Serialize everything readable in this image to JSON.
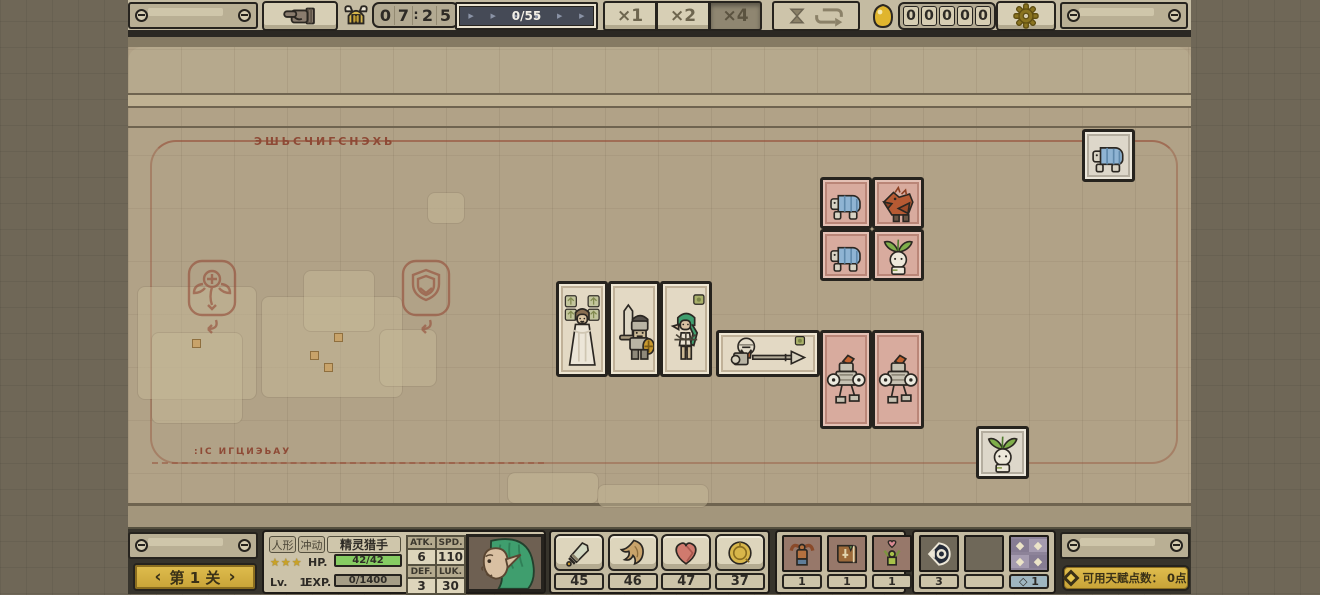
{
  "topbar": {
    "timer_digits": [
      "0",
      "7",
      "2",
      "5"
    ],
    "timer_colon": ":",
    "progress_text": "0/55",
    "speeds": [
      {
        "id": "x1",
        "label": "×1",
        "active": false
      },
      {
        "id": "x2",
        "label": "×2",
        "active": false
      },
      {
        "id": "x4",
        "label": "×4",
        "active": true
      }
    ],
    "gold_digits": [
      "0",
      "0",
      "0",
      "0",
      "0"
    ]
  },
  "board": {
    "rune_top": "ЭШЬСЧИГСНЭХЬ",
    "rune_bottom": ":IС ИГЦИЭЬАУ",
    "blobs": [
      {
        "x": 10,
        "y": 254,
        "w": 118,
        "h": 112
      },
      {
        "x": 24,
        "y": 300,
        "w": 90,
        "h": 90
      },
      {
        "x": 134,
        "y": 264,
        "w": 140,
        "h": 100
      },
      {
        "x": 176,
        "y": 238,
        "w": 70,
        "h": 60
      },
      {
        "x": 252,
        "y": 297,
        "w": 56,
        "h": 56
      },
      {
        "x": 300,
        "y": 160,
        "w": 36,
        "h": 30
      },
      {
        "x": 380,
        "y": 440,
        "w": 90,
        "h": 30
      },
      {
        "x": 470,
        "y": 452,
        "w": 110,
        "h": 22
      }
    ],
    "dots": [
      {
        "x": 64,
        "y": 306
      },
      {
        "x": 182,
        "y": 318
      },
      {
        "x": 206,
        "y": 300
      },
      {
        "x": 196,
        "y": 330
      }
    ],
    "links": [
      {
        "dir": "v",
        "x": 706,
        "y": 163,
        "w": 6,
        "h": 66
      },
      {
        "dir": "h",
        "x": 700,
        "y": 316,
        "w": 88,
        "h": 5
      },
      {
        "dir": "h",
        "x": 700,
        "y": 354,
        "w": 88,
        "h": 5
      }
    ],
    "units": [
      {
        "type": "turtle",
        "style": "gray",
        "x": 954,
        "y": 96,
        "w": 53,
        "h": 53
      },
      {
        "type": "turtle",
        "style": "pink",
        "x": 692,
        "y": 144,
        "w": 52,
        "h": 52
      },
      {
        "type": "dragon",
        "style": "pink",
        "x": 744,
        "y": 144,
        "w": 52,
        "h": 52
      },
      {
        "type": "turtle",
        "style": "pink",
        "x": 692,
        "y": 196,
        "w": 52,
        "h": 52
      },
      {
        "type": "sprout",
        "style": "pink",
        "x": 744,
        "y": 196,
        "w": 52,
        "h": 52
      },
      {
        "type": "lady",
        "style": "cream",
        "x": 428,
        "y": 248,
        "w": 52,
        "h": 96
      },
      {
        "type": "knight",
        "style": "cream",
        "x": 480,
        "y": 248,
        "w": 52,
        "h": 96
      },
      {
        "type": "elf",
        "style": "cream",
        "x": 532,
        "y": 248,
        "w": 52,
        "h": 96
      },
      {
        "type": "lancer",
        "style": "cream",
        "x": 588,
        "y": 297,
        "w": 104,
        "h": 47
      },
      {
        "type": "robot",
        "style": "pink",
        "x": 692,
        "y": 297,
        "w": 52,
        "h": 99
      },
      {
        "type": "robot",
        "style": "pink",
        "x": 744,
        "y": 297,
        "w": 52,
        "h": 99
      },
      {
        "type": "sprout",
        "style": "gray",
        "x": 848,
        "y": 393,
        "w": 53,
        "h": 53
      }
    ]
  },
  "bottombar": {
    "stage_label": "第 1 关",
    "chevron_left": "‹",
    "chevron_right": "›",
    "character": {
      "race_tag": "人形",
      "trait_tag": "冲动",
      "name": "精灵猎手",
      "stars": "★★★",
      "lv_label": "Lv.",
      "lv_value": "1",
      "hp_label": "HP.",
      "hp_value": "42/42",
      "exp_label": "EXP.",
      "exp_value": "0/1400",
      "stats": [
        {
          "label": "ATK.",
          "value": "6"
        },
        {
          "label": "SPD.",
          "value": "110"
        },
        {
          "label": "DEF.",
          "value": "3"
        },
        {
          "label": "LUK.",
          "value": "30"
        }
      ]
    },
    "resources": [
      {
        "icon": "sword",
        "value": "45"
      },
      {
        "icon": "wing",
        "value": "46"
      },
      {
        "icon": "heart",
        "value": "47"
      },
      {
        "icon": "coin",
        "value": "37"
      }
    ],
    "consumables": [
      {
        "icon": "strength-potion",
        "count": "1"
      },
      {
        "icon": "skill-book",
        "count": "1"
      },
      {
        "icon": "cheer",
        "count": "1"
      }
    ],
    "badges": [
      {
        "icon": "eye-crest",
        "count": "3"
      },
      {
        "icon": "empty",
        "count": ""
      },
      {
        "icon": "gem-grid",
        "count": "◇ 1"
      }
    ],
    "talent_label": "可用天赋点数： 0点"
  }
}
